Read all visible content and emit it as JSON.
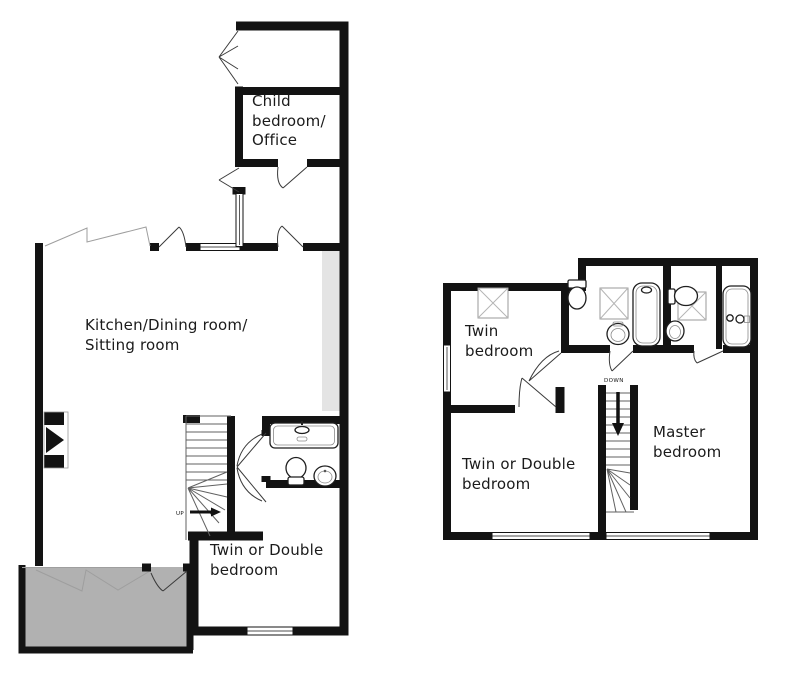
{
  "document_type": "property-floor-plan",
  "colors": {
    "wall": "#131313",
    "terrace_fill": "#b1b1b1",
    "alcove_strip_fill": "#e4e4e4",
    "fixture_outline": "#1f1f1f",
    "text": "#1b1b1b",
    "background": "#ffffff"
  },
  "ground_floor": {
    "rooms": [
      {
        "id": "child-bedroom-office",
        "label": "Child\nbedroom/\nOffice"
      },
      {
        "id": "kitchen-dining-sitting",
        "label": "Kitchen/Dining room/\nSitting room"
      },
      {
        "id": "twin-or-double-bedroom",
        "label": "Twin or Double\nbedroom"
      }
    ],
    "stairs_label": "UP",
    "features": [
      "entrance-porch",
      "hall-glazed-screen",
      "fireplace",
      "bathroom-bath-toilet-sink",
      "terrace"
    ]
  },
  "first_floor": {
    "rooms": [
      {
        "id": "twin-bedroom",
        "label": "Twin\nbedroom"
      },
      {
        "id": "twin-or-double-bedroom",
        "label": "Twin or Double\nbedroom"
      },
      {
        "id": "master-bedroom",
        "label": "Master\nbedroom"
      }
    ],
    "stairs_label": "DOWN",
    "features": [
      "shower-room",
      "ensuite-bathroom",
      "three-shower-trays",
      "two-baths"
    ]
  }
}
